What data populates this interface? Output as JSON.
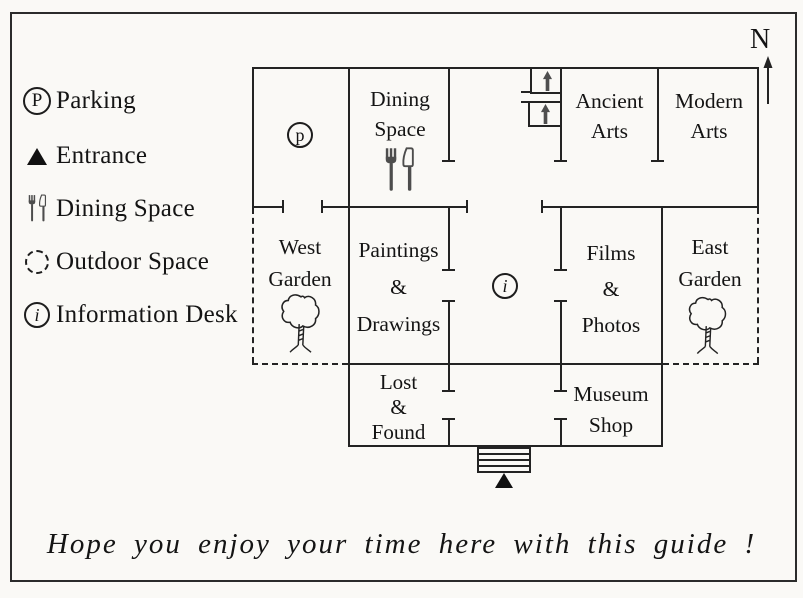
{
  "legend": {
    "items": [
      {
        "icon": "parking-circle-icon",
        "symbol": "P",
        "label": "Parking"
      },
      {
        "icon": "entrance-triangle-icon",
        "label": "Entrance"
      },
      {
        "icon": "fork-knife-icon",
        "label": "Dining Space"
      },
      {
        "icon": "outdoor-dashed-circle-icon",
        "label": "Outdoor Space"
      },
      {
        "icon": "information-circle-icon",
        "symbol": "i",
        "label": "Information Desk"
      }
    ]
  },
  "compass": {
    "label": "N"
  },
  "map": {
    "parking_symbol": "p",
    "info_symbol": "i",
    "rooms": {
      "dining": [
        "Dining",
        "Space"
      ],
      "ancient_arts": [
        "Ancient",
        "Arts"
      ],
      "modern_arts": [
        "Modern",
        "Arts"
      ],
      "west_garden": [
        "West",
        "Garden"
      ],
      "paintings_drawings": [
        "Paintings",
        "&",
        "Drawings"
      ],
      "films_photos": [
        "Films",
        "&",
        "Photos"
      ],
      "east_garden": [
        "East",
        "Garden"
      ],
      "lost_found": [
        "Lost",
        "&",
        "Found"
      ],
      "museum_shop": [
        "Museum",
        "Shop"
      ]
    }
  },
  "footer": {
    "message": "Hope you enjoy your time here with this guide !"
  },
  "colors": {
    "line": "#232323",
    "background": "#faf9f6",
    "icon_gray": "#4d4d4d"
  }
}
